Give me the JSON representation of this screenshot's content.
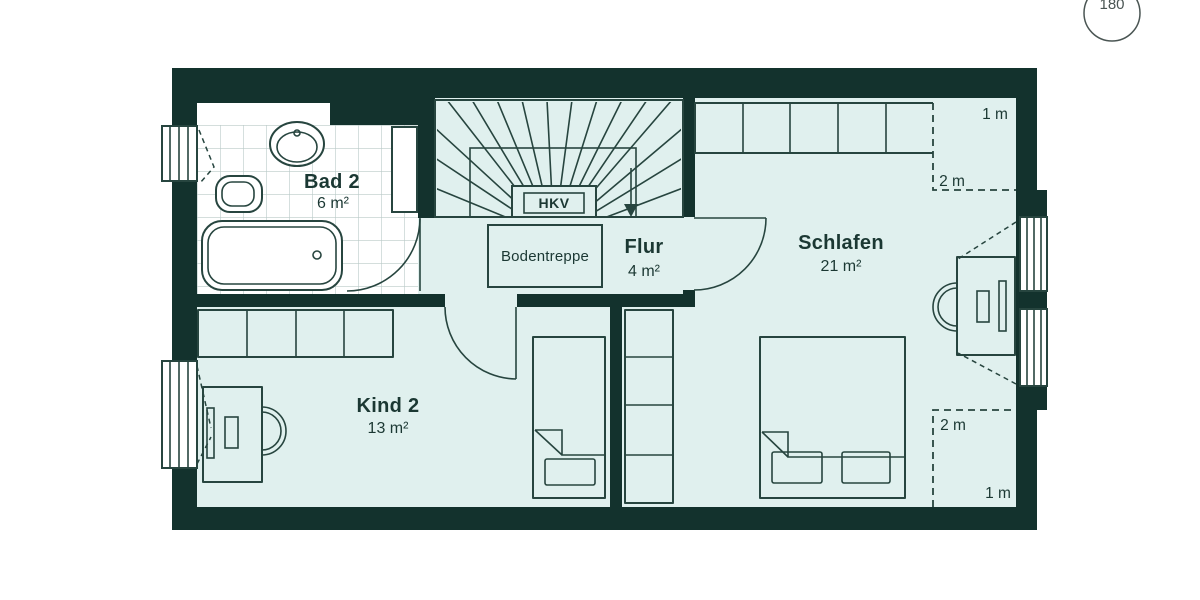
{
  "badge": {
    "text": "180"
  },
  "colors": {
    "wall": "#13322d",
    "floor": "#e0f0ee",
    "line": "#27453f",
    "tile": "#b9c9c7",
    "text": "#1b3833",
    "fixture": "#ffffff"
  },
  "rooms": {
    "bad2": {
      "name": "Bad 2",
      "area": "6 m²"
    },
    "flur": {
      "name": "Flur",
      "area": "4 m²"
    },
    "schlafen": {
      "name": "Schlafen",
      "area": "21 m²"
    },
    "kind2": {
      "name": "Kind 2",
      "area": "13 m²"
    }
  },
  "annotations": {
    "hkv": "HKV",
    "bodentreppe": "Bodentreppe",
    "roof_top": {
      "h1": "1 m",
      "h2": "2 m"
    },
    "roof_bottom": {
      "h1": "1 m",
      "h2": "2 m"
    }
  }
}
